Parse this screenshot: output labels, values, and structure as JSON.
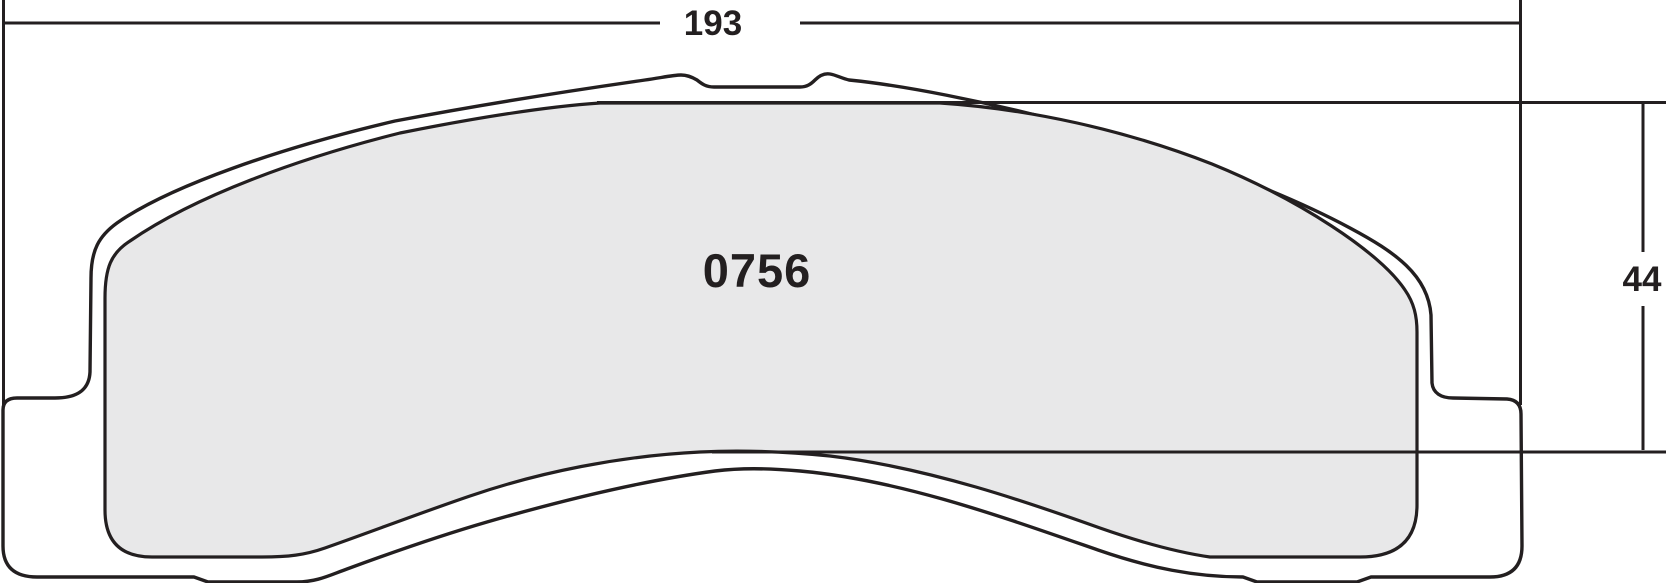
{
  "drawing": {
    "title": "brake-pad-outline-drawing",
    "part_number": "0756",
    "dimensions": {
      "width_label": "193",
      "height_label": "44"
    },
    "colors": {
      "line": "#231f20",
      "friction_fill": "#e8e8e9",
      "background": "#ffffff"
    }
  }
}
